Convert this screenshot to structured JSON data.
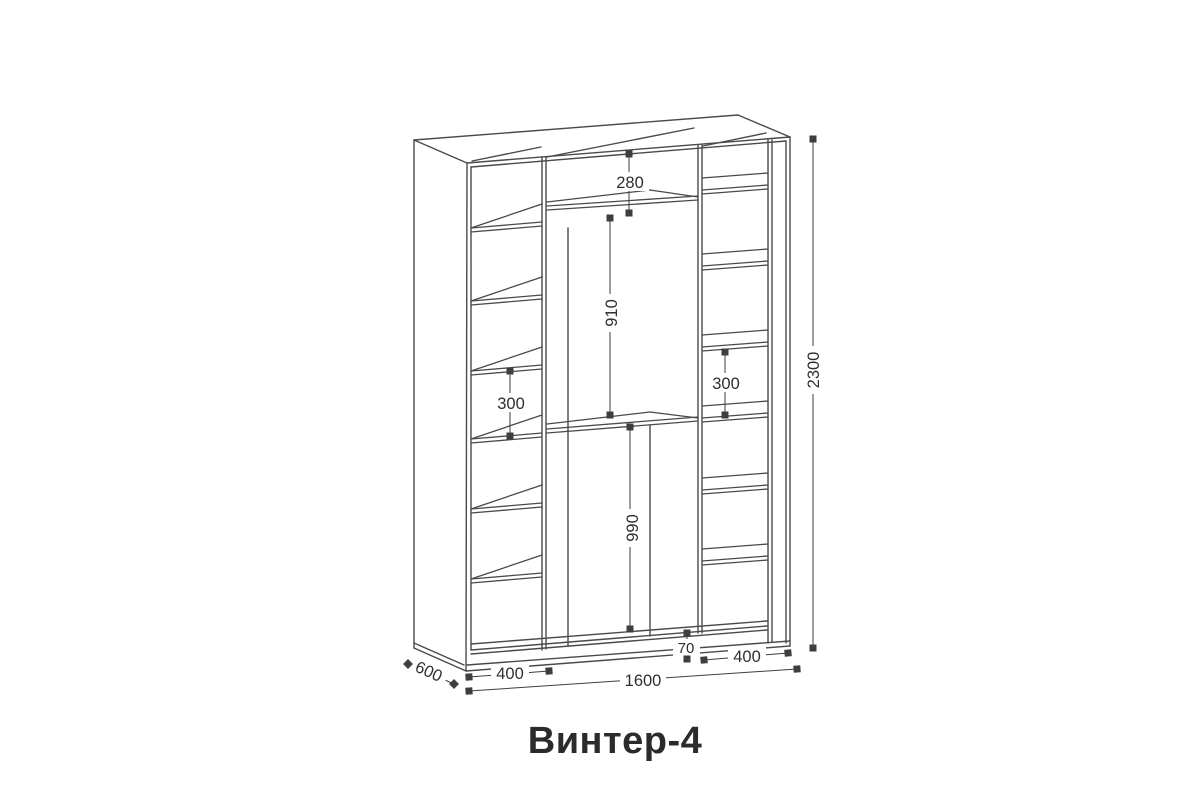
{
  "title": "Винтер-4",
  "drawing": {
    "kind": "wardrobe technical dimension drawing",
    "dimensions": {
      "total_height": "2300",
      "total_width": "1600",
      "depth": "600",
      "left_column_width": "400",
      "right_column_width": "400",
      "top_shelf_height": "280",
      "upper_section_height": "910",
      "lower_section_height": "990",
      "left_shelf_spacing": "300",
      "right_shelf_spacing": "300",
      "base_height": "70"
    },
    "colors": {
      "structure": "#4a4a4a",
      "dimension": "#3e3e3e",
      "label_text": "#2f2f2f",
      "title_text": "#2b2b2b",
      "background": "#ffffff"
    }
  }
}
